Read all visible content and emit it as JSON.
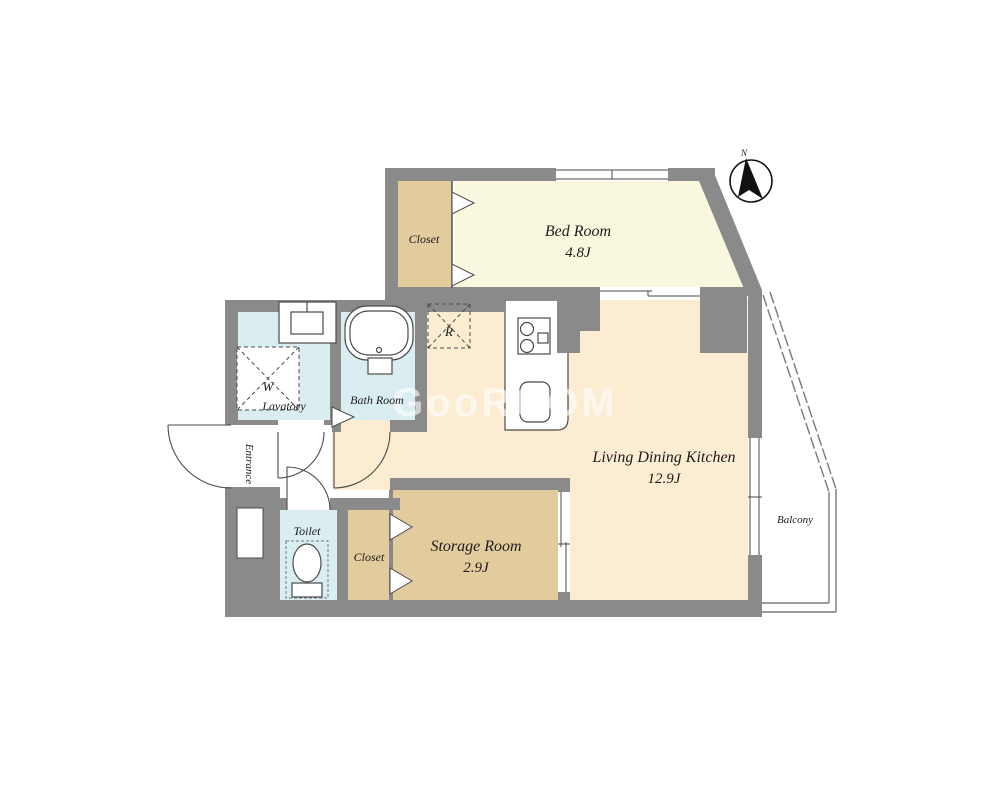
{
  "floorplan": {
    "watermark": "GooROOM",
    "compass": {
      "north_label": "N"
    },
    "rooms": {
      "bedroom": {
        "name": "Bed Room",
        "area": "4.8J"
      },
      "living_dining_kitchen": {
        "name": "Living Dining Kitchen",
        "area": "12.9J"
      },
      "storage_room": {
        "name": "Storage Room",
        "area": "2.9J"
      },
      "closet_upper": {
        "name": "Closet"
      },
      "closet_lower": {
        "name": "Closet"
      },
      "bath_room": {
        "name": "Bath Room"
      },
      "lavatory": {
        "name": "Lavatory"
      },
      "toilet": {
        "name": "Toilet"
      },
      "entrance": {
        "name": "Entrance"
      },
      "balcony": {
        "name": "Balcony"
      }
    },
    "appliances": {
      "washing_machine": "W",
      "refrigerator": "R"
    },
    "colors": {
      "wall": "#8a8a8a",
      "line": "#4a4a4a",
      "bedroom_floor": "#faf7df",
      "ldk_floor": "#fcecd2",
      "closet_floor": "#e2cb9d",
      "wet_area_floor": "#daeef2",
      "background": "#ffffff"
    }
  }
}
